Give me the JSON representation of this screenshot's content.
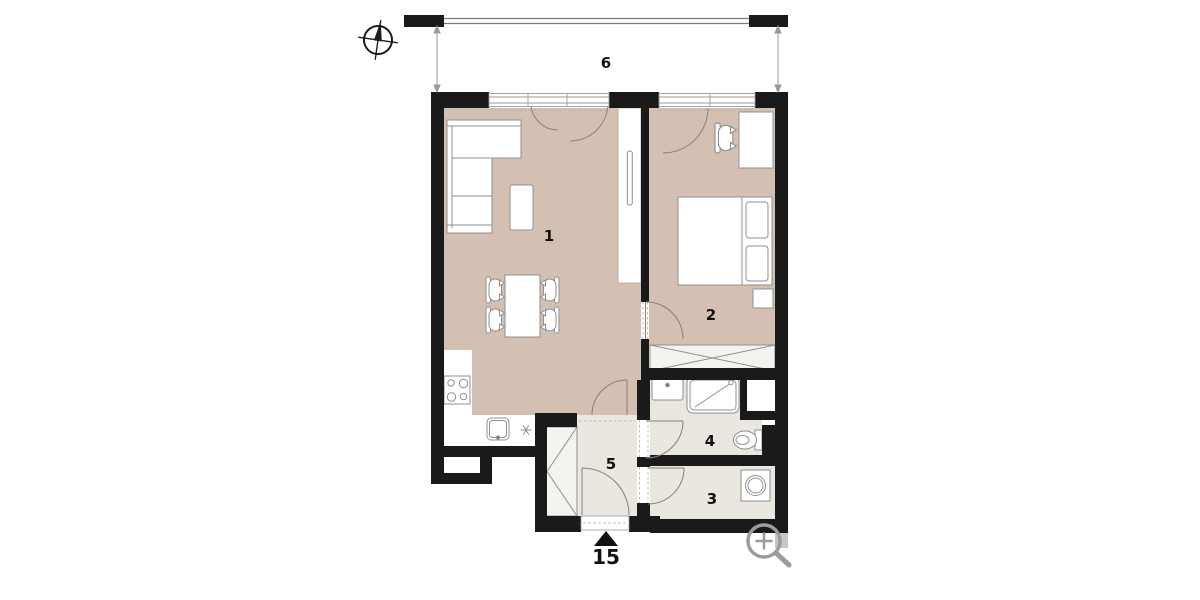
{
  "labels": {
    "room1": "1",
    "room2": "2",
    "room3": "3",
    "room4": "4",
    "room5": "5",
    "balcony": "6",
    "entrance": "15"
  },
  "colors": {
    "wall": "#1a1a1a",
    "wall_gray": "#c7c7c7",
    "floor_main": "#d3c0b2",
    "floor_light": "#eae6e0",
    "wardrobe_fill": "#f5f3ef",
    "furniture_fill": "#ffffff",
    "furniture_stroke": "#8f8f8f",
    "door_stroke": "#8a8076",
    "dash_stroke": "#b3a89b",
    "window_stroke": "#9a9a9a",
    "railing_stroke": "#7d7d7d",
    "dimension_stroke": "#9a9a9a",
    "icon_gray": "#9c9c9c",
    "compass_color": "#1c1c1c",
    "label_color": "#111111"
  }
}
